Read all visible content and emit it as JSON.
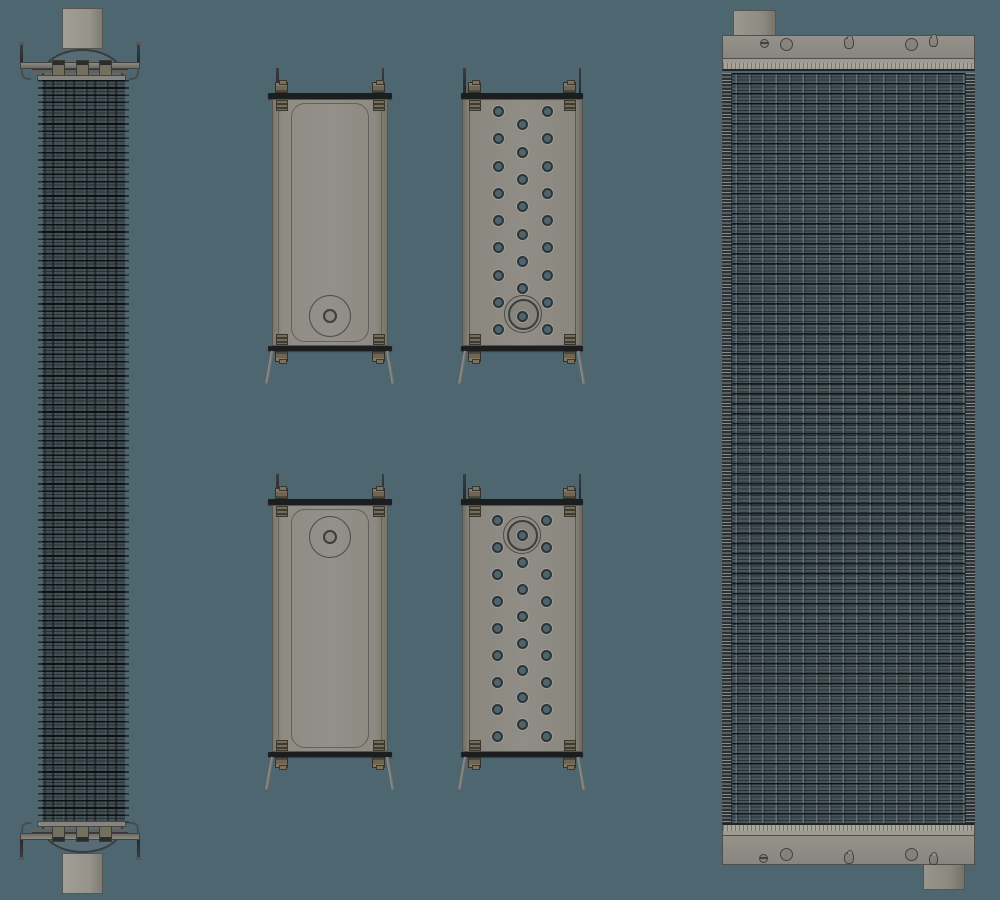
{
  "scene": {
    "description": "orthographic-cad-views-radiator-assembly",
    "view_count": 6
  },
  "colors": {
    "background": "#4d6670",
    "metal": "#8e8b84",
    "metal_light": "#9d9a92",
    "metal_dark": "#6f6c65",
    "flange": "#1b1d1f",
    "outline": "#3c3e40",
    "bolt": "#6e6555",
    "bolt_dark": "#3a372f",
    "core_fill": "#46555c",
    "core_fill_side": "#404d54",
    "fin_line": "#15191b",
    "tube_highlight": "#858e90",
    "hole_fill": "#4f656e",
    "hole_ring": "#2d3437"
  },
  "views": {
    "side_view": {
      "name": "radiator-side-view"
    },
    "front_view": {
      "name": "radiator-front-view"
    },
    "tank_views": [
      {
        "name": "top-tank-side-view",
        "type": "plain",
        "x": 268,
        "w": 124,
        "pin_inset": 8,
        "flange_y": 93,
        "body_x": 272,
        "body_w": 116,
        "body_h": 247,
        "port": {
          "cx": 330,
          "cy": 316,
          "rings": [
            21,
            7
          ]
        }
      },
      {
        "name": "top-tank-tubesheet-view",
        "type": "perforated",
        "x": 461,
        "w": 122,
        "pin_inset": 2,
        "flange_y": 93,
        "body_x": 461.5,
        "body_w": 121,
        "body_h": 247,
        "port": {
          "cx": 523,
          "cy": 314,
          "rings": [
            19,
            15.5
          ]
        },
        "holes": [
          {
            "x": 498,
            "rows": [
              111,
              138,
              166,
              193,
              220,
              247,
              275,
              302,
              329
            ]
          },
          {
            "x": 522.5,
            "rows": [
              124,
              152,
              179,
              206,
              234,
              261,
              288,
              316
            ]
          },
          {
            "x": 547,
            "rows": [
              111,
              138,
              166,
              193,
              220,
              247,
              275,
              302,
              329
            ]
          }
        ]
      },
      {
        "name": "bottom-tank-side-view",
        "type": "plain",
        "x": 268,
        "w": 124,
        "pin_inset": 8,
        "flange_y": 499,
        "body_x": 272,
        "body_w": 116,
        "body_h": 247,
        "port": {
          "cx": 330,
          "cy": 537,
          "rings": [
            21,
            7
          ]
        }
      },
      {
        "name": "bottom-tank-tubesheet-view",
        "type": "perforated",
        "x": 461,
        "w": 122,
        "pin_inset": 2,
        "flange_y": 499,
        "body_x": 461.5,
        "body_w": 121,
        "body_h": 247,
        "port": {
          "cx": 522,
          "cy": 535,
          "rings": [
            19,
            15.5
          ]
        },
        "holes": [
          {
            "x": 497.5,
            "rows": [
              520,
              547,
              574,
              601,
              628,
              655,
              682,
              709,
              736
            ]
          },
          {
            "x": 522,
            "rows": [
              535,
              562,
              589,
              616,
              643,
              670,
              697,
              724
            ]
          },
          {
            "x": 546.5,
            "rows": [
              520,
              547,
              574,
              601,
              628,
              655,
              682,
              709,
              736
            ]
          }
        ]
      }
    ],
    "front_ports_top": [
      {
        "x": 764,
        "y": 43,
        "w": 9,
        "h": 9,
        "kind": "vent"
      },
      {
        "x": 786,
        "y": 44,
        "w": 13,
        "h": 13,
        "kind": "round"
      },
      {
        "x": 849,
        "y": 43,
        "w": 10,
        "h": 12,
        "kind": "oval"
      },
      {
        "x": 911,
        "y": 44,
        "w": 13,
        "h": 13,
        "kind": "round"
      },
      {
        "x": 933,
        "y": 41,
        "w": 9,
        "h": 11,
        "kind": "oval"
      }
    ],
    "front_ports_bottom": [
      {
        "x": 763,
        "y": 858,
        "w": 9,
        "h": 9,
        "kind": "vent"
      },
      {
        "x": 786,
        "y": 854,
        "w": 13,
        "h": 13,
        "kind": "round"
      },
      {
        "x": 849,
        "y": 858,
        "w": 10,
        "h": 12,
        "kind": "oval"
      },
      {
        "x": 911,
        "y": 854,
        "w": 13,
        "h": 13,
        "kind": "round"
      },
      {
        "x": 933,
        "y": 859,
        "w": 9,
        "h": 11,
        "kind": "oval"
      }
    ]
  }
}
